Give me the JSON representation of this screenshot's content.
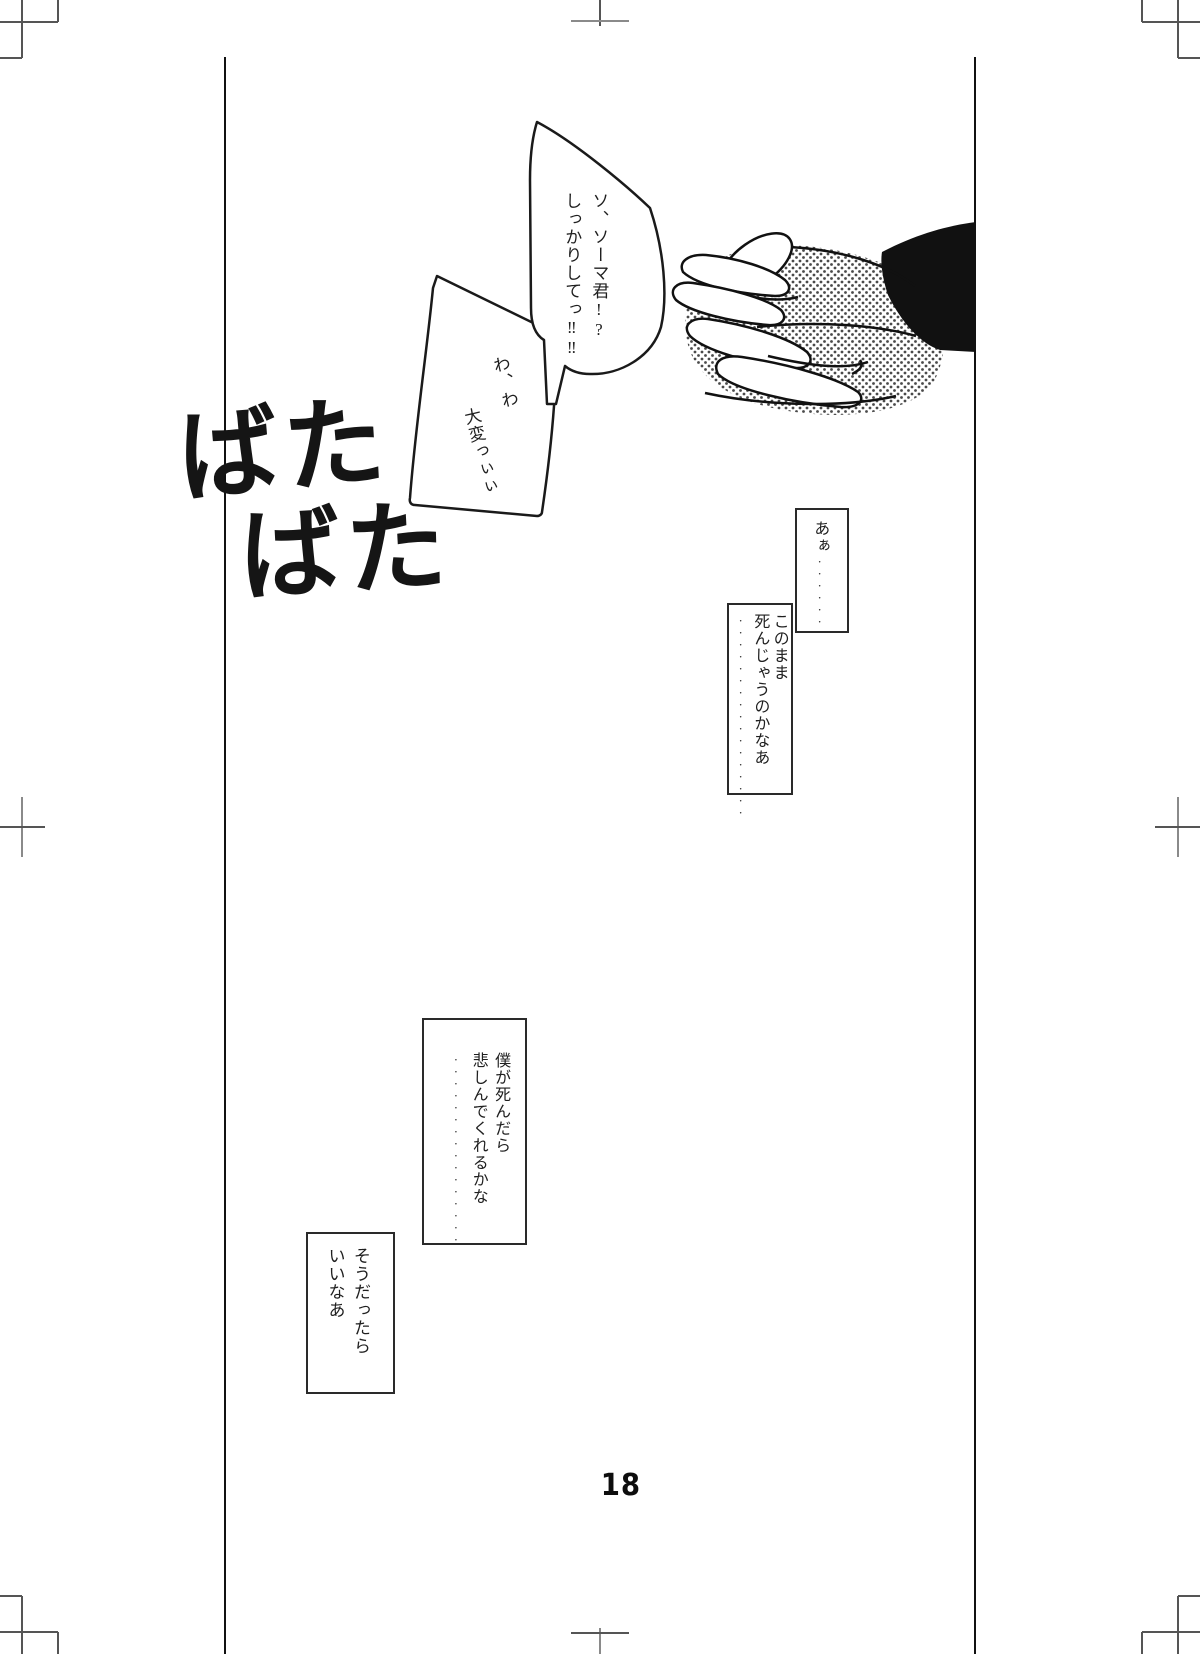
{
  "colors": {
    "paper": "#ffffff",
    "ink": "#1a1a1a"
  },
  "page": {
    "number": "18"
  },
  "sfx": {
    "line1": "ばた",
    "line2": "ばた"
  },
  "bubbles": [
    {
      "lines": [
        "ソ、ソーマ君!?",
        "しっかりしてっ‼‼"
      ]
    },
    {
      "lines": [
        "わ、わ",
        "大変っぃぃ"
      ]
    }
  ],
  "captions": [
    {
      "lines": [
        "あぁ"
      ],
      "dots": "······"
    },
    {
      "lines": [
        "このまま",
        "死んじゃうのかなあ"
      ],
      "dots": "·················"
    },
    {
      "lines": [
        "僕が死んだら",
        "悲しんでくれるかな"
      ],
      "dots": "················"
    },
    {
      "lines": [
        "そうだったら",
        "いいなあ"
      ],
      "dots": ""
    }
  ]
}
